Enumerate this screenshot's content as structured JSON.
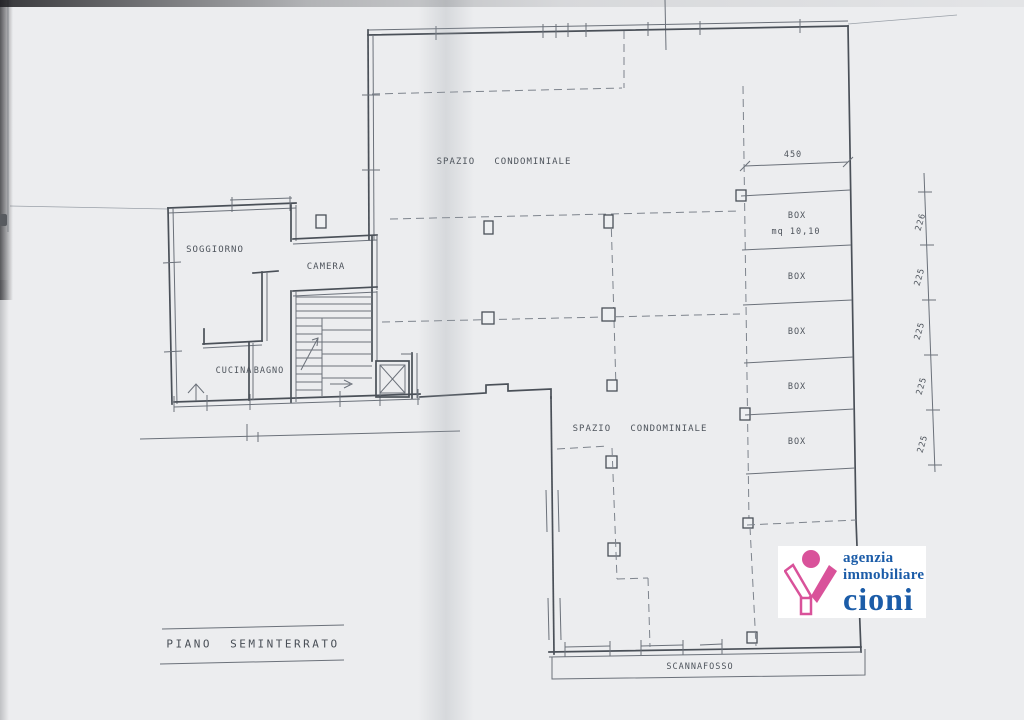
{
  "document": {
    "title": "PIANO  SEMINTERRATO",
    "rooms": {
      "soggiorno": "SOGGIORNO",
      "camera": "CAMERA",
      "cucina": "CUCINA",
      "bagno": "BAGNO"
    },
    "common_areas": {
      "spazio_condominiale_upper": "SPAZIO   CONDOMINIALE",
      "spazio_condominiale_lower": "SPAZIO   CONDOMINIALE",
      "scannafosso": "SCANNAFOSSO"
    },
    "garage_boxes": [
      {
        "label": "BOX",
        "area": "mq 10,10"
      },
      {
        "label": "BOX"
      },
      {
        "label": "BOX"
      },
      {
        "label": "BOX"
      },
      {
        "label": "BOX"
      }
    ],
    "dimensions": {
      "top_width": "450",
      "right_side": [
        "226",
        "225",
        "225",
        "225",
        "225"
      ]
    }
  },
  "logo": {
    "line1": "agenzia",
    "line2": "immobiliare",
    "line3": "cioni",
    "brand_pink": "#d9529a",
    "brand_blue": "#1b5ca8"
  }
}
